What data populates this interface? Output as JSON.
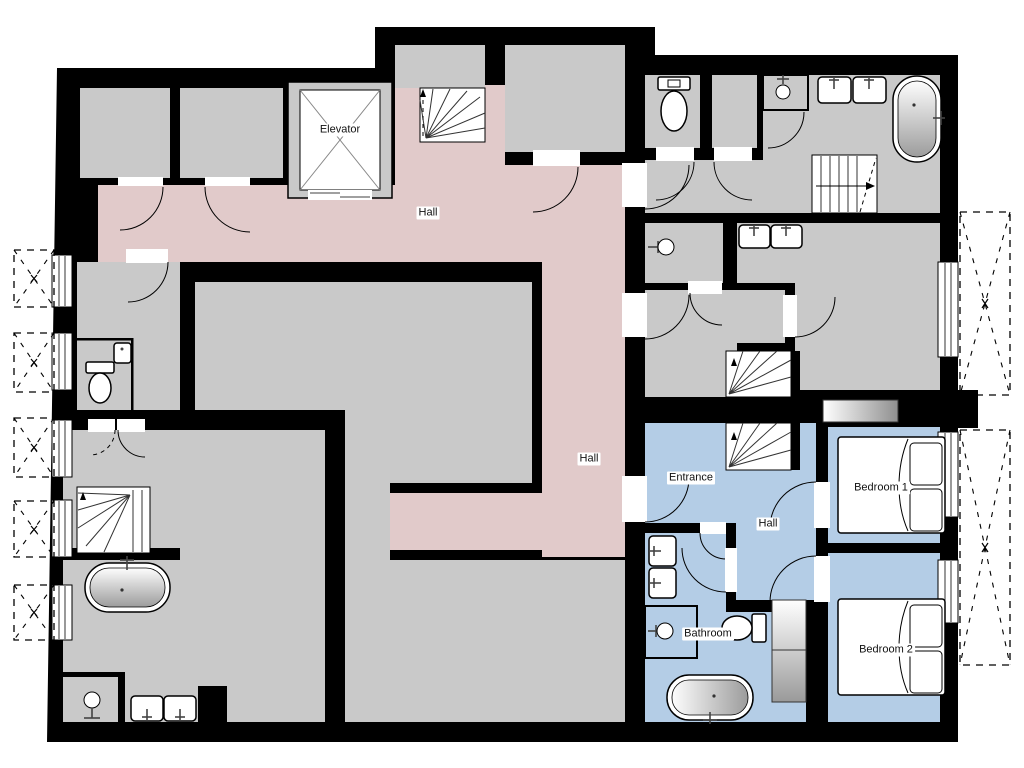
{
  "title": "Apartment floor plan",
  "colors": {
    "wall": "#000000",
    "room_floor": "#c9c9c9",
    "hall_floor": "#e1caca",
    "apartment_floor": "#b4cde6",
    "fixture_fill": "#ffffff"
  },
  "rooms": {
    "elevator": {
      "label": "Elevator"
    },
    "hall_top": {
      "label": "Hall"
    },
    "hall_main": {
      "label": "Hall"
    },
    "entrance": {
      "label": "Entrance"
    },
    "hall_apartment": {
      "label": "Hall"
    },
    "bedroom_1": {
      "label": "Bedroom 1"
    },
    "bedroom_2": {
      "label": "Bedroom 2"
    },
    "bathroom": {
      "label": "Bathroom"
    }
  },
  "fixtures": {
    "bathtubs": 3,
    "toilets": 3,
    "showers": 4,
    "double_sinks": 4,
    "single_sinks": 1,
    "beds": 2,
    "staircases": 5,
    "wardrobes": 2,
    "balconies_dashed": 7
  }
}
